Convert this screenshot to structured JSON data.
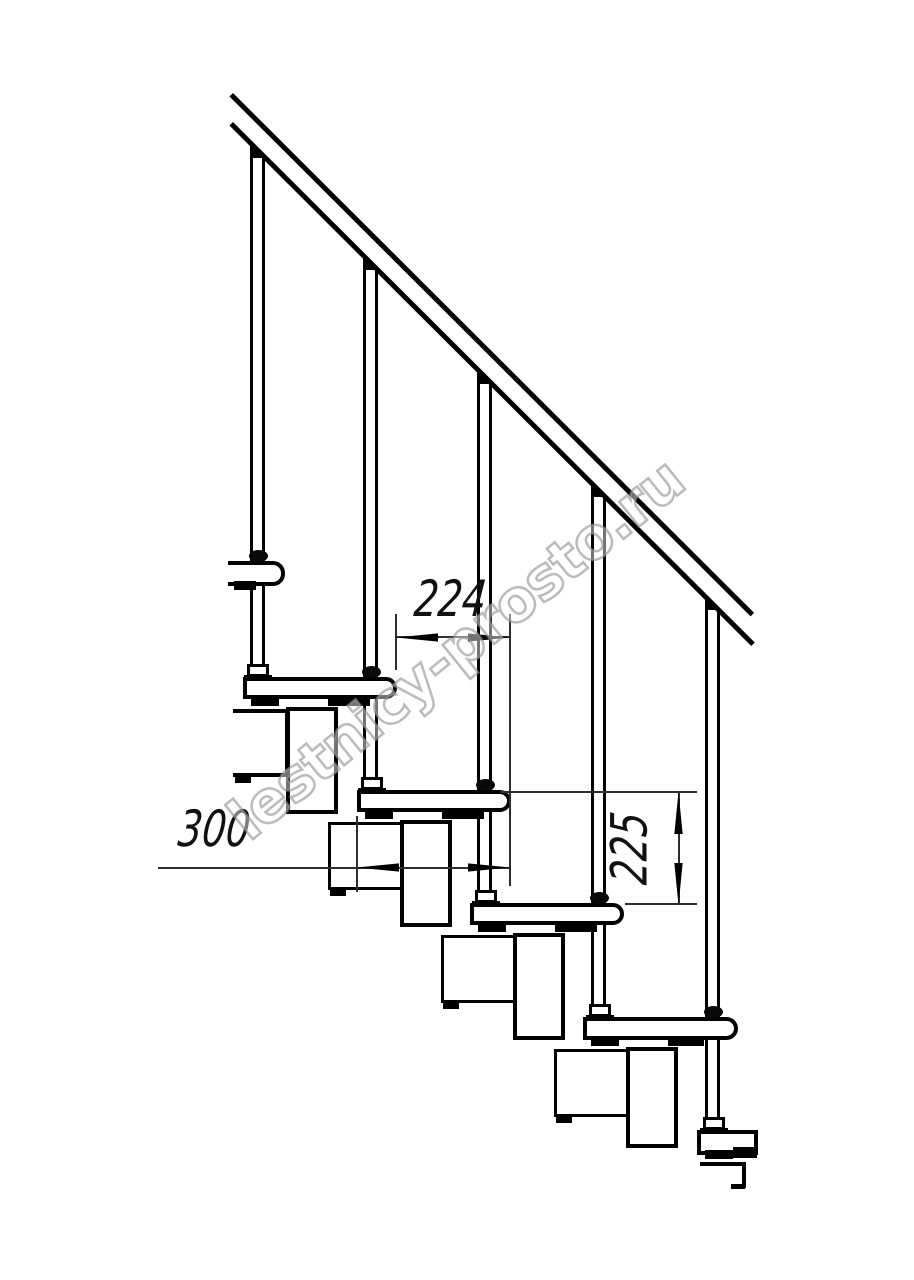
{
  "meta": {
    "type": "technical-drawing",
    "subject": "Modular staircase side-view fragment with handrail, balusters, treads and central stringer modules"
  },
  "dimensions": {
    "going": {
      "value": "224",
      "meaning": "horizontal step pitch, mm"
    },
    "depth": {
      "value": "300",
      "meaning": "tread depth, mm"
    },
    "riser": {
      "value": "225",
      "meaning": "riser height between tread tops, mm"
    }
  },
  "watermark": {
    "text": "lestnicy-prosto.ru"
  },
  "colors": {
    "line": "#000000",
    "dim_line": "#2e2e2e",
    "watermark_stroke": "#919191",
    "background": "#ffffff"
  }
}
